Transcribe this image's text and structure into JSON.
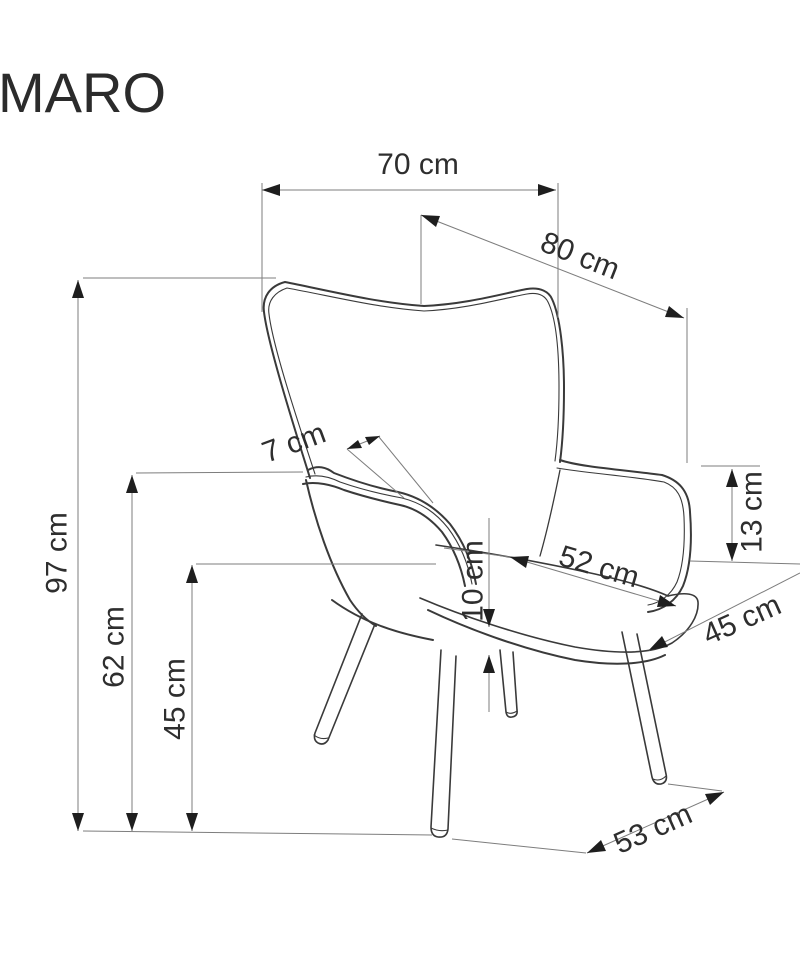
{
  "title": "MARO",
  "dimensions": {
    "total_width": {
      "label": "70 cm"
    },
    "total_depth": {
      "label": "80 cm"
    },
    "total_height": {
      "label": "97 cm"
    },
    "armrest_height": {
      "label": "62 cm"
    },
    "seat_height": {
      "label": "45 cm"
    },
    "armrest_thickness": {
      "label": "7 cm"
    },
    "wing_height": {
      "label": "13 cm"
    },
    "seat_width": {
      "label": "52 cm"
    },
    "cushion_thickness": {
      "label": "10 cm"
    },
    "seat_depth": {
      "label": "45 cm"
    },
    "leg_span": {
      "label": "53 cm"
    }
  },
  "colors": {
    "background": "#ffffff",
    "chair_outline": "#3a3a3a",
    "dimension_line": "#7d7d7d",
    "arrowhead": "#1e1e1e",
    "text": "#2e2e2e"
  }
}
